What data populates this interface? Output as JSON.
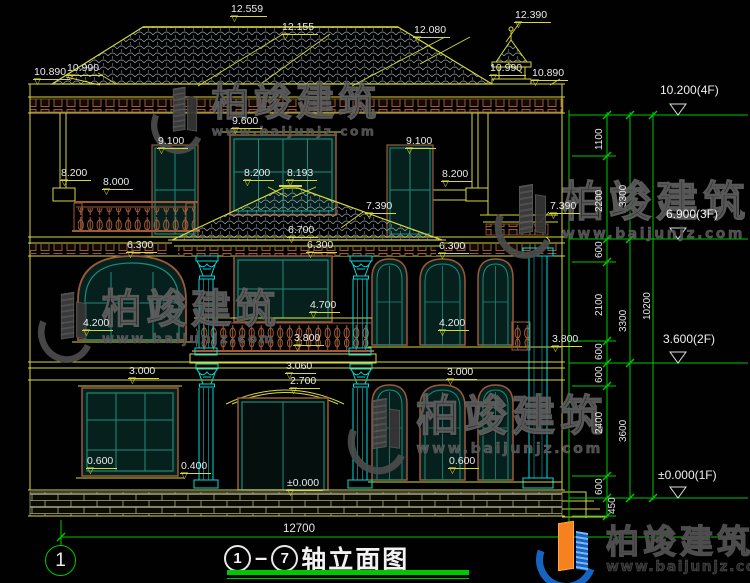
{
  "drawing": {
    "title": {
      "axis_from": "1",
      "axis_to": "7",
      "text": "轴立面图"
    },
    "grid_bubble": "1",
    "overall_width": "12700",
    "icons": {
      "level_triangle": "▽"
    },
    "levels": [
      {
        "t": "12.559",
        "x": 230,
        "y": 3
      },
      {
        "t": "12.155",
        "x": 281,
        "y": 21
      },
      {
        "t": "12.080",
        "x": 413,
        "y": 24
      },
      {
        "t": "12.390",
        "x": 514,
        "y": 9
      },
      {
        "t": "10.890",
        "x": 33,
        "y": 66
      },
      {
        "t": "10.990",
        "x": 66,
        "y": 62
      },
      {
        "t": "10.990",
        "x": 489,
        "y": 62
      },
      {
        "t": "10.890",
        "x": 531,
        "y": 67
      },
      {
        "t": "9.600",
        "x": 231,
        "y": 115
      },
      {
        "t": "9.100",
        "x": 157,
        "y": 135
      },
      {
        "t": "9.100",
        "x": 405,
        "y": 135
      },
      {
        "t": "8.200",
        "x": 60,
        "y": 167
      },
      {
        "t": "8.000",
        "x": 102,
        "y": 176
      },
      {
        "t": "8.200",
        "x": 243,
        "y": 167
      },
      {
        "t": "8.193",
        "x": 286,
        "y": 167
      },
      {
        "t": "8.200",
        "x": 441,
        "y": 168
      },
      {
        "t": "7.390",
        "x": 365,
        "y": 200
      },
      {
        "t": "7.390",
        "x": 549,
        "y": 200
      },
      {
        "t": "6.700",
        "x": 287,
        "y": 224
      },
      {
        "t": "6.300",
        "x": 126,
        "y": 239
      },
      {
        "t": "6.300",
        "x": 306,
        "y": 239
      },
      {
        "t": "6.300",
        "x": 438,
        "y": 240
      },
      {
        "t": "4.700",
        "x": 309,
        "y": 299
      },
      {
        "t": "3.800",
        "x": 293,
        "y": 332
      },
      {
        "t": "3.060",
        "x": 285,
        "y": 360
      },
      {
        "t": "2.700",
        "x": 289,
        "y": 375
      },
      {
        "t": "4.200",
        "x": 82,
        "y": 317
      },
      {
        "t": "4.200",
        "x": 438,
        "y": 317
      },
      {
        "t": "3.800",
        "x": 551,
        "y": 333
      },
      {
        "t": "3.000",
        "x": 128,
        "y": 365
      },
      {
        "t": "3.000",
        "x": 446,
        "y": 366
      },
      {
        "t": "0.600",
        "x": 86,
        "y": 455
      },
      {
        "t": "0.400",
        "x": 180,
        "y": 460
      },
      {
        "t": "0.600",
        "x": 448,
        "y": 455
      },
      {
        "t": "±0.000",
        "x": 286,
        "y": 477
      }
    ],
    "floor_levels": [
      {
        "t": "10.200(4F)",
        "x": 660,
        "y": 84
      },
      {
        "t": "6.900(3F)",
        "x": 666,
        "y": 208
      },
      {
        "t": "3.600(2F)",
        "x": 663,
        "y": 333
      },
      {
        "t": "±0.000(1F)",
        "x": 658,
        "y": 469
      }
    ],
    "chain_dims": [
      {
        "t": "1100",
        "x": 595,
        "y": 150
      },
      {
        "t": "2200",
        "x": 595,
        "y": 212
      },
      {
        "t": "3300",
        "x": 619,
        "y": 207
      },
      {
        "t": "600",
        "x": 595,
        "y": 258
      },
      {
        "t": "2100",
        "x": 595,
        "y": 316
      },
      {
        "t": "3300",
        "x": 619,
        "y": 332
      },
      {
        "t": "600",
        "x": 595,
        "y": 360
      },
      {
        "t": "600",
        "x": 595,
        "y": 383
      },
      {
        "t": "2400",
        "x": 595,
        "y": 434
      },
      {
        "t": "3600",
        "x": 619,
        "y": 442
      },
      {
        "t": "600",
        "x": 595,
        "y": 495
      },
      {
        "t": "450",
        "x": 608,
        "y": 514
      },
      {
        "t": "10200",
        "x": 643,
        "y": 320
      }
    ]
  },
  "watermark": {
    "brand": "柏竣建筑",
    "url": "www.baijunjz.com",
    "items": [
      {
        "x": 153,
        "y": 84,
        "s": 0.9
      },
      {
        "x": 497,
        "y": 181,
        "s": 1.0
      },
      {
        "x": 40,
        "y": 289,
        "s": 0.95
      },
      {
        "x": 350,
        "y": 395,
        "s": 1.02
      }
    ]
  },
  "footer": {
    "brand": "柏竣建筑",
    "url": "www.baijunjz.com"
  },
  "colors": {
    "line_yellow": "#d8d83a",
    "dim_green": "#00c800",
    "column_cyan": "#00dcdc",
    "trim_brown": "#9a5a38",
    "window_teal": "#1d8a7a",
    "tile_gray": "#93a6b0",
    "text_white": "#eaeaea",
    "logo_blue": "#1565c0",
    "logo_orange": "#f5821f"
  }
}
